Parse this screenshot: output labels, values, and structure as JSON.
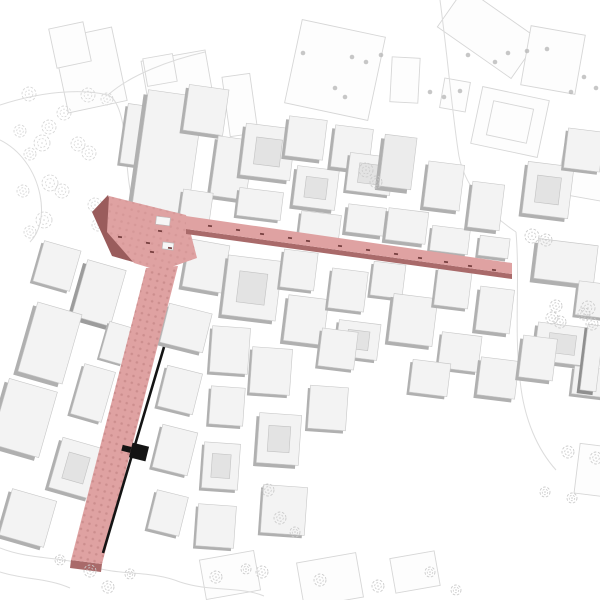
{
  "meta": {
    "label": "Axonometric urban site plan with highlighted L-shaped pedestrian street route"
  },
  "canvas": {
    "w": 600,
    "h": 600
  },
  "colors": {
    "background": "#ffffff",
    "outline": "#d6d6d6",
    "outline_fill": "#fdfdfd",
    "curve": "#dcdcdc",
    "tree_park": "#d7d7d7",
    "tree_sketch": "#cbcbcb",
    "tree_dot": "#b9b9b9",
    "bldg_top": "#f3f3f3",
    "bldg_side": "#b0b0b0",
    "bldg_stroke": "#c7c7c7",
    "court_fill": "#e3e3e3",
    "court_stroke": "#c2c2c2",
    "route_fill": "#dfa2a2",
    "route_dot": "#c98b8b",
    "route_edge": "#a96a6a",
    "route_shadow": "#9a5c5c",
    "mark": "#6b3535",
    "kiosk_fill": "#f6f6f6",
    "kiosk_stroke": "#bbbbbb",
    "black": "#141414"
  },
  "route": {
    "plaza_pts": "109,196 186,215 197,258 160,271 134,263 107,232",
    "plaza_shadow_pts": "92,212 108,195 133,262 112,256",
    "h_street_pts": "186,216 512,263 512,274 186,229",
    "h_street_face_pts": "186,229 512,274 512,279 186,234",
    "v_street_pts": "146,268 178,266 102,564 71,560",
    "v_street_face_pts": "71,560 102,564 101,572 70,568",
    "pattern": {
      "size": 7,
      "dot_r": 1.3,
      "rotate": 14
    },
    "black_line": {
      "x1": 164,
      "y1": 347,
      "x2": 103,
      "y2": 553,
      "w": 2.6
    },
    "marker": {
      "x": 139,
      "y": 452,
      "w": 17,
      "h": 15,
      "r": 14,
      "stub_w": 9,
      "stub_h": 6
    },
    "kiosks": [
      {
        "x": 163,
        "y": 221,
        "w": 14,
        "h": 8,
        "r": 7
      },
      {
        "x": 168,
        "y": 246,
        "w": 11,
        "h": 7,
        "r": 7
      }
    ],
    "street_marks": [
      {
        "x": 210,
        "y": 226
      },
      {
        "x": 238,
        "y": 230
      },
      {
        "x": 262,
        "y": 234
      },
      {
        "x": 290,
        "y": 238
      },
      {
        "x": 308,
        "y": 241
      },
      {
        "x": 340,
        "y": 246
      },
      {
        "x": 368,
        "y": 250
      },
      {
        "x": 396,
        "y": 254
      },
      {
        "x": 420,
        "y": 258
      },
      {
        "x": 446,
        "y": 262
      },
      {
        "x": 470,
        "y": 266
      },
      {
        "x": 494,
        "y": 270
      },
      {
        "x": 120,
        "y": 237
      },
      {
        "x": 148,
        "y": 243
      },
      {
        "x": 160,
        "y": 231
      },
      {
        "x": 170,
        "y": 248
      },
      {
        "x": 152,
        "y": 252
      }
    ]
  },
  "outline_buildings": [
    {
      "x": 90,
      "y": 70,
      "w": 60,
      "h": 75,
      "r": -12
    },
    {
      "x": 70,
      "y": 45,
      "w": 35,
      "h": 40,
      "r": -12
    },
    {
      "x": 180,
      "y": 95,
      "w": 65,
      "h": 80,
      "r": -10
    },
    {
      "x": 160,
      "y": 70,
      "w": 30,
      "h": 28,
      "r": -10
    },
    {
      "x": 240,
      "y": 105,
      "w": 28,
      "h": 60,
      "r": -8
    },
    {
      "x": 335,
      "y": 70,
      "w": 85,
      "h": 85,
      "r": 12
    },
    {
      "x": 405,
      "y": 80,
      "w": 28,
      "h": 45,
      "r": 3
    },
    {
      "x": 488,
      "y": 33,
      "w": 90,
      "h": 48,
      "r": 35
    },
    {
      "x": 553,
      "y": 60,
      "w": 55,
      "h": 60,
      "r": 10
    },
    {
      "x": 510,
      "y": 122,
      "w": 68,
      "h": 58,
      "r": 12,
      "inner": 1
    },
    {
      "x": 583,
      "y": 170,
      "w": 45,
      "h": 55,
      "r": 10
    },
    {
      "x": 455,
      "y": 95,
      "w": 26,
      "h": 30,
      "r": 10
    },
    {
      "x": 230,
      "y": 575,
      "w": 55,
      "h": 40,
      "r": -10
    },
    {
      "x": 330,
      "y": 580,
      "w": 60,
      "h": 45,
      "r": -10
    },
    {
      "x": 415,
      "y": 572,
      "w": 45,
      "h": 35,
      "r": -10
    },
    {
      "x": 592,
      "y": 470,
      "w": 30,
      "h": 50,
      "r": 7
    }
  ],
  "curves": [
    "M 0,105 C 40,92 80,88 108,95 C 118,99 124,120 126,150 C 128,185 132,215 148,240",
    "M 108,95 C 130,75 170,60 205,52",
    "M 440,0 C 448,60 452,110 458,150 C 462,185 490,215 516,232",
    "M 516,232 C 520,280 514,330 520,380 C 524,420 538,450 556,470",
    "M 0,548 C 30,560 60,556 90,566 C 120,576 150,570 180,582 C 210,592 240,586 264,596",
    "M 0,572 C 25,580 48,578 70,588",
    "M 148,240 C 150,252 152,258 155,264",
    "M 0,140 C 20,150 35,170 40,195 C 44,215 40,232 30,242"
  ],
  "park_trees": [
    {
      "x": 29,
      "y": 94,
      "s": 7
    },
    {
      "x": 88,
      "y": 95,
      "s": 7
    },
    {
      "x": 107,
      "y": 99,
      "s": 6
    },
    {
      "x": 64,
      "y": 113,
      "s": 7
    },
    {
      "x": 49,
      "y": 127,
      "s": 7
    },
    {
      "x": 20,
      "y": 131,
      "s": 6
    },
    {
      "x": 42,
      "y": 143,
      "s": 8
    },
    {
      "x": 78,
      "y": 144,
      "s": 7
    },
    {
      "x": 30,
      "y": 154,
      "s": 6
    },
    {
      "x": 89,
      "y": 153,
      "s": 7
    },
    {
      "x": 50,
      "y": 183,
      "s": 8
    },
    {
      "x": 23,
      "y": 191,
      "s": 6
    },
    {
      "x": 62,
      "y": 191,
      "s": 7
    },
    {
      "x": 95,
      "y": 205,
      "s": 7
    },
    {
      "x": 44,
      "y": 220,
      "s": 8
    },
    {
      "x": 30,
      "y": 232,
      "s": 6
    },
    {
      "x": 98,
      "y": 225,
      "s": 6
    }
  ],
  "sketch_trees": [
    {
      "x": 366,
      "y": 170,
      "s": 7
    },
    {
      "x": 376,
      "y": 182,
      "s": 6
    },
    {
      "x": 532,
      "y": 236,
      "s": 7
    },
    {
      "x": 546,
      "y": 240,
      "s": 6
    },
    {
      "x": 556,
      "y": 306,
      "s": 6
    },
    {
      "x": 588,
      "y": 308,
      "s": 7
    },
    {
      "x": 560,
      "y": 322,
      "s": 6
    },
    {
      "x": 592,
      "y": 324,
      "s": 6
    },
    {
      "x": 552,
      "y": 318,
      "s": 6
    },
    {
      "x": 584,
      "y": 314,
      "s": 6
    },
    {
      "x": 568,
      "y": 452,
      "s": 6
    },
    {
      "x": 596,
      "y": 458,
      "s": 6
    },
    {
      "x": 545,
      "y": 492,
      "s": 5
    },
    {
      "x": 572,
      "y": 498,
      "s": 5
    },
    {
      "x": 268,
      "y": 490,
      "s": 6
    },
    {
      "x": 280,
      "y": 518,
      "s": 6
    },
    {
      "x": 295,
      "y": 532,
      "s": 5
    },
    {
      "x": 90,
      "y": 571,
      "s": 6
    },
    {
      "x": 108,
      "y": 587,
      "s": 6
    },
    {
      "x": 130,
      "y": 574,
      "s": 5
    },
    {
      "x": 216,
      "y": 577,
      "s": 6
    },
    {
      "x": 246,
      "y": 569,
      "s": 5
    },
    {
      "x": 262,
      "y": 572,
      "s": 6
    },
    {
      "x": 320,
      "y": 580,
      "s": 6
    },
    {
      "x": 378,
      "y": 586,
      "s": 6
    },
    {
      "x": 430,
      "y": 572,
      "s": 5
    },
    {
      "x": 456,
      "y": 590,
      "s": 5
    },
    {
      "x": 60,
      "y": 560,
      "s": 5
    }
  ],
  "dot_trees": [
    {
      "x": 303,
      "y": 53
    },
    {
      "x": 352,
      "y": 57
    },
    {
      "x": 366,
      "y": 62
    },
    {
      "x": 381,
      "y": 55
    },
    {
      "x": 430,
      "y": 92
    },
    {
      "x": 444,
      "y": 97
    },
    {
      "x": 460,
      "y": 91
    },
    {
      "x": 468,
      "y": 55
    },
    {
      "x": 495,
      "y": 62
    },
    {
      "x": 508,
      "y": 53
    },
    {
      "x": 527,
      "y": 51
    },
    {
      "x": 547,
      "y": 49
    },
    {
      "x": 584,
      "y": 77
    },
    {
      "x": 596,
      "y": 88
    },
    {
      "x": 571,
      "y": 92
    },
    {
      "x": 345,
      "y": 97
    },
    {
      "x": 335,
      "y": 88
    }
  ],
  "buildings": [
    {
      "x": 137,
      "y": 135,
      "w": 26,
      "h": 60,
      "r": 8,
      "e": 4
    },
    {
      "x": 168,
      "y": 152,
      "w": 56,
      "h": 118,
      "r": 8,
      "e": 7
    },
    {
      "x": 206,
      "y": 110,
      "w": 40,
      "h": 46,
      "r": 8,
      "e": 5
    },
    {
      "x": 232,
      "y": 168,
      "w": 36,
      "h": 60,
      "r": 8,
      "e": 5
    },
    {
      "x": 196,
      "y": 208,
      "w": 30,
      "h": 34,
      "r": 8,
      "e": 4
    },
    {
      "x": 268,
      "y": 152,
      "w": 50,
      "h": 52,
      "r": 7,
      "e": 5,
      "c": 1
    },
    {
      "x": 260,
      "y": 204,
      "w": 44,
      "h": 28,
      "r": 7,
      "e": 4
    },
    {
      "x": 306,
      "y": 138,
      "w": 38,
      "h": 40,
      "r": 7,
      "e": 5
    },
    {
      "x": 316,
      "y": 188,
      "w": 42,
      "h": 40,
      "r": 7,
      "e": 5,
      "c": 1
    },
    {
      "x": 352,
      "y": 148,
      "w": 38,
      "h": 42,
      "r": 7,
      "e": 5
    },
    {
      "x": 370,
      "y": 174,
      "w": 44,
      "h": 38,
      "r": 7,
      "e": 4,
      "c": 1
    },
    {
      "x": 320,
      "y": 226,
      "w": 40,
      "h": 26,
      "r": 7,
      "e": 4
    },
    {
      "x": 366,
      "y": 220,
      "w": 38,
      "h": 28,
      "r": 7,
      "e": 5
    },
    {
      "x": 398,
      "y": 162,
      "w": 32,
      "h": 52,
      "r": 7,
      "e": 6,
      "t": "#ececec"
    },
    {
      "x": 407,
      "y": 226,
      "w": 40,
      "h": 32,
      "r": 7,
      "e": 5
    },
    {
      "x": 444,
      "y": 186,
      "w": 36,
      "h": 46,
      "r": 7,
      "e": 5
    },
    {
      "x": 450,
      "y": 240,
      "w": 38,
      "h": 25,
      "r": 7,
      "e": 4
    },
    {
      "x": 486,
      "y": 206,
      "w": 32,
      "h": 46,
      "r": 7,
      "e": 5
    },
    {
      "x": 494,
      "y": 247,
      "w": 30,
      "h": 20,
      "r": 7,
      "e": 4
    },
    {
      "x": 548,
      "y": 190,
      "w": 46,
      "h": 52,
      "r": 7,
      "e": 5,
      "c": 1
    },
    {
      "x": 584,
      "y": 150,
      "w": 36,
      "h": 40,
      "r": 7,
      "e": 4
    },
    {
      "x": 566,
      "y": 262,
      "w": 60,
      "h": 40,
      "r": 7,
      "e": 6
    },
    {
      "x": 596,
      "y": 300,
      "w": 38,
      "h": 34,
      "r": 7,
      "e": 4
    },
    {
      "x": 562,
      "y": 344,
      "w": 52,
      "h": 38,
      "r": 7,
      "e": 5,
      "c": 1
    },
    {
      "x": 592,
      "y": 382,
      "w": 38,
      "h": 28,
      "r": 7,
      "e": 4
    },
    {
      "x": 206,
      "y": 266,
      "w": 40,
      "h": 48,
      "r": 10,
      "e": 5
    },
    {
      "x": 252,
      "y": 288,
      "w": 54,
      "h": 60,
      "r": 7,
      "e": 5,
      "c": 1
    },
    {
      "x": 299,
      "y": 270,
      "w": 34,
      "h": 38,
      "r": 7,
      "e": 4
    },
    {
      "x": 306,
      "y": 320,
      "w": 40,
      "h": 46,
      "r": 7,
      "e": 5
    },
    {
      "x": 348,
      "y": 290,
      "w": 36,
      "h": 40,
      "r": 7,
      "e": 4
    },
    {
      "x": 388,
      "y": 280,
      "w": 32,
      "h": 34,
      "r": 7,
      "e": 4
    },
    {
      "x": 358,
      "y": 340,
      "w": 42,
      "h": 36,
      "r": 7,
      "e": 4,
      "c": 1
    },
    {
      "x": 413,
      "y": 320,
      "w": 44,
      "h": 48,
      "r": 7,
      "e": 5
    },
    {
      "x": 453,
      "y": 288,
      "w": 34,
      "h": 38,
      "r": 7,
      "e": 4
    },
    {
      "x": 495,
      "y": 310,
      "w": 34,
      "h": 44,
      "r": 7,
      "e": 5
    },
    {
      "x": 460,
      "y": 352,
      "w": 40,
      "h": 36,
      "r": 7,
      "e": 4
    },
    {
      "x": 430,
      "y": 378,
      "w": 38,
      "h": 33,
      "r": 7,
      "e": 4
    },
    {
      "x": 498,
      "y": 378,
      "w": 38,
      "h": 38,
      "r": 7,
      "e": 5
    },
    {
      "x": 538,
      "y": 358,
      "w": 34,
      "h": 42,
      "r": 7,
      "e": 5
    },
    {
      "x": 186,
      "y": 328,
      "w": 44,
      "h": 40,
      "r": 14,
      "e": 5
    },
    {
      "x": 230,
      "y": 350,
      "w": 38,
      "h": 46,
      "r": 4,
      "e": 4
    },
    {
      "x": 180,
      "y": 390,
      "w": 36,
      "h": 42,
      "r": 14,
      "e": 4
    },
    {
      "x": 227,
      "y": 406,
      "w": 34,
      "h": 38,
      "r": 4,
      "e": 4
    },
    {
      "x": 175,
      "y": 450,
      "w": 36,
      "h": 44,
      "r": 14,
      "e": 4
    },
    {
      "x": 221,
      "y": 466,
      "w": 36,
      "h": 46,
      "r": 4,
      "e": 4,
      "c": 1
    },
    {
      "x": 168,
      "y": 513,
      "w": 32,
      "h": 40,
      "r": 14,
      "e": 4
    },
    {
      "x": 216,
      "y": 526,
      "w": 38,
      "h": 42,
      "r": 4,
      "e": 4
    },
    {
      "x": 271,
      "y": 371,
      "w": 40,
      "h": 46,
      "r": 4,
      "e": 4
    },
    {
      "x": 279,
      "y": 439,
      "w": 42,
      "h": 50,
      "r": 4,
      "e": 5,
      "c": 1
    },
    {
      "x": 284,
      "y": 510,
      "w": 44,
      "h": 48,
      "r": 4,
      "e": 4
    },
    {
      "x": 328,
      "y": 408,
      "w": 38,
      "h": 43,
      "r": 4,
      "e": 4
    },
    {
      "x": 338,
      "y": 349,
      "w": 36,
      "h": 38,
      "r": 7,
      "e": 4
    },
    {
      "x": 99,
      "y": 293,
      "w": 40,
      "h": 58,
      "r": 16,
      "e": 6,
      "s": "#9c9c9c"
    },
    {
      "x": 57,
      "y": 266,
      "w": 38,
      "h": 42,
      "r": 16,
      "e": 4
    },
    {
      "x": 50,
      "y": 343,
      "w": 46,
      "h": 72,
      "r": 16,
      "e": 6
    },
    {
      "x": 24,
      "y": 418,
      "w": 50,
      "h": 68,
      "r": 16,
      "e": 6
    },
    {
      "x": 93,
      "y": 393,
      "w": 32,
      "h": 52,
      "r": 16,
      "e": 4
    },
    {
      "x": 76,
      "y": 468,
      "w": 42,
      "h": 52,
      "r": 16,
      "e": 5,
      "c": 1
    },
    {
      "x": 28,
      "y": 518,
      "w": 46,
      "h": 48,
      "r": 16,
      "e": 5
    },
    {
      "x": 116,
      "y": 343,
      "w": 24,
      "h": 38,
      "r": 16,
      "e": 3
    },
    {
      "x": 592,
      "y": 358,
      "w": 16,
      "h": 66,
      "r": 7,
      "e": 5,
      "s": "#8f8f8f"
    }
  ]
}
